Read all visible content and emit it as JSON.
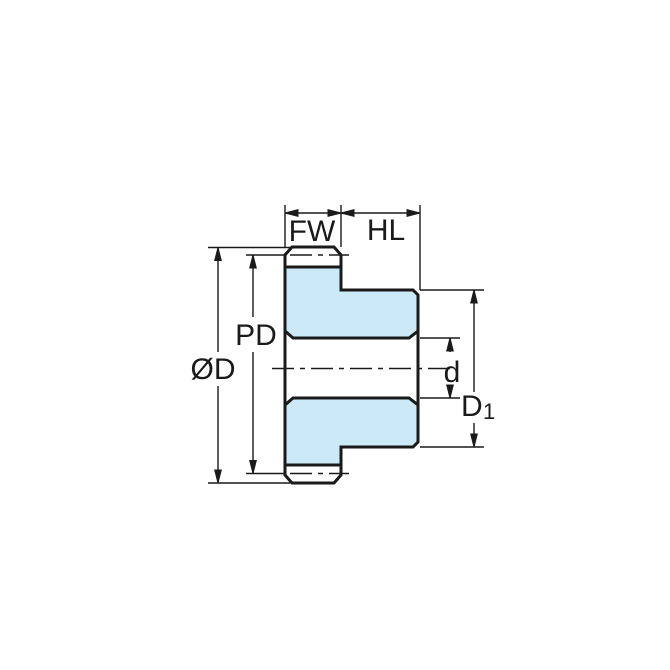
{
  "diagram": {
    "labels": {
      "face_width": "FW",
      "hub_length": "HL",
      "pitch_diameter": "PD",
      "outer_diameter": "ØD",
      "bore_diameter": "d",
      "hub_diameter_main": "D",
      "hub_diameter_sub": "1"
    },
    "colors": {
      "gear_fill": "#cce9f8",
      "tooth_fill": "#ffffff",
      "outline": "#1a1a1a",
      "dimension": "#1a1a1a",
      "background": "#ffffff"
    }
  }
}
